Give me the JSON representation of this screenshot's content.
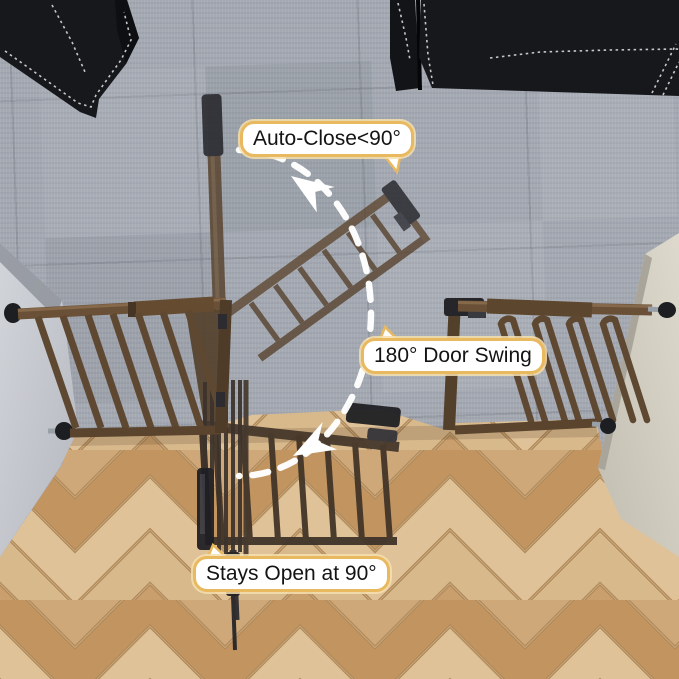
{
  "annotations": {
    "auto_close": {
      "text": "Auto-Close<90°"
    },
    "door_swing": {
      "text": "180° Door Swing"
    },
    "stays_open": {
      "text": "Stays Open at 90°"
    }
  },
  "icons": {
    "swing_arc": "dashed-ellipse",
    "arrow_top": "arrow-up-left",
    "arrow_bottom": "arrow-down-left"
  },
  "style": {
    "bubble_border_color": "#e9b95f",
    "bubble_background": "#ffffff",
    "arc_color": "#ffffff",
    "gate_color": "#6a5036",
    "gate_dark_color": "#26262a",
    "carpet_color": "#a4a9b2",
    "wood_color": "#d3b185",
    "couch_color": "#17181c",
    "left_wall_color": "#c8cbd1",
    "right_wall_color": "#d8d4c8"
  }
}
